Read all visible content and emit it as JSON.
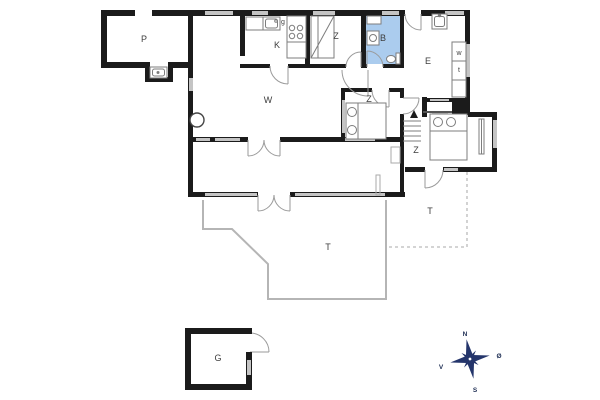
{
  "plan": {
    "rooms": [
      {
        "id": "annex",
        "label": "P"
      },
      {
        "id": "kitchen",
        "label": "K"
      },
      {
        "id": "bunk-bedroom",
        "label": "Z"
      },
      {
        "id": "bathroom",
        "label": "B"
      },
      {
        "id": "entrance-hall",
        "label": "E"
      },
      {
        "id": "living-room",
        "label": "W"
      },
      {
        "id": "middle-bedroom",
        "label": "Z"
      },
      {
        "id": "right-bedroom",
        "label": "Z"
      },
      {
        "id": "main-terrace",
        "label": "T"
      },
      {
        "id": "side-terrace",
        "label": "T"
      },
      {
        "id": "outbuilding",
        "label": "G"
      }
    ],
    "appliances": {
      "dishwasher_label": "g",
      "washing_machine_label": "w",
      "dryer_label": "t"
    },
    "compass": {
      "north": "N",
      "east": "Ø",
      "south": "S",
      "west": "V"
    },
    "colors": {
      "wall": "#1b1b1b",
      "bathroom_floor": "#abccee",
      "window": "#c4c4c4",
      "terrace_outline": "#b5b5b5",
      "compass_star": "#24356b"
    }
  }
}
